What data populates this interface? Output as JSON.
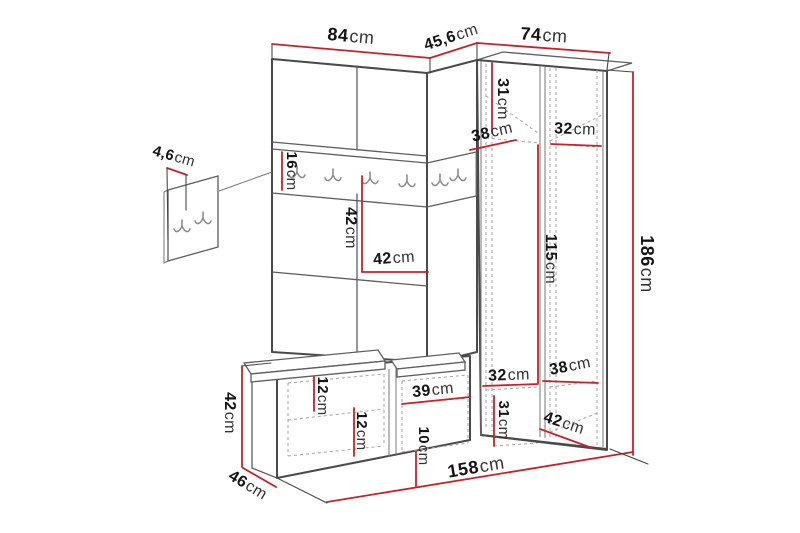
{
  "diagram": {
    "type": "furniture-dimension-drawing",
    "subject": "corner-hallway-unit-with-coat-rack-wardrobe-and-bench",
    "colors": {
      "dimension_line": "#c4232b",
      "outline": "#4a4a4a",
      "hidden_line": "#a3a3a3",
      "background": "#ffffff"
    },
    "icons": {
      "coat_hook": "double-coat-hook-icon"
    },
    "dimensions": {
      "top_width_left": {
        "value": "84",
        "unit": "cm"
      },
      "top_width_corner": {
        "value": "45,6",
        "unit": "cm"
      },
      "top_width_right": {
        "value": "74",
        "unit": "cm"
      },
      "total_height": {
        "value": "186",
        "unit": "cm"
      },
      "panel_thickness": {
        "value": "4,6",
        "unit": "cm"
      },
      "rail_height": {
        "value": "16",
        "unit": "cm"
      },
      "open_shelf_height": {
        "value": "42",
        "unit": "cm"
      },
      "open_shelf_width": {
        "value": "42",
        "unit": "cm"
      },
      "wardrobe_top_shelf_height": {
        "value": "31",
        "unit": "cm"
      },
      "wardrobe_top_depth": {
        "value": "38",
        "unit": "cm"
      },
      "wardrobe_top_shelf_width": {
        "value": "32",
        "unit": "cm"
      },
      "hanging_height": {
        "value": "115",
        "unit": "cm"
      },
      "bench_height": {
        "value": "42",
        "unit": "cm"
      },
      "bench_depth": {
        "value": "46",
        "unit": "cm"
      },
      "bench_cushion_inset": {
        "value": "12",
        "unit": "cm"
      },
      "bench_shelf_height": {
        "value": "12",
        "unit": "cm"
      },
      "bench_compartment_width": {
        "value": "39",
        "unit": "cm"
      },
      "bench_shelf_gap": {
        "value": "10",
        "unit": "cm"
      },
      "wardrobe_bottom_shelf_width": {
        "value": "32",
        "unit": "cm"
      },
      "wardrobe_bottom_shelf_height": {
        "value": "31",
        "unit": "cm"
      },
      "wardrobe_bottom_depth": {
        "value": "38",
        "unit": "cm"
      },
      "wardrobe_bottom_width": {
        "value": "42",
        "unit": "cm"
      },
      "total_width": {
        "value": "158",
        "unit": "cm"
      }
    }
  }
}
